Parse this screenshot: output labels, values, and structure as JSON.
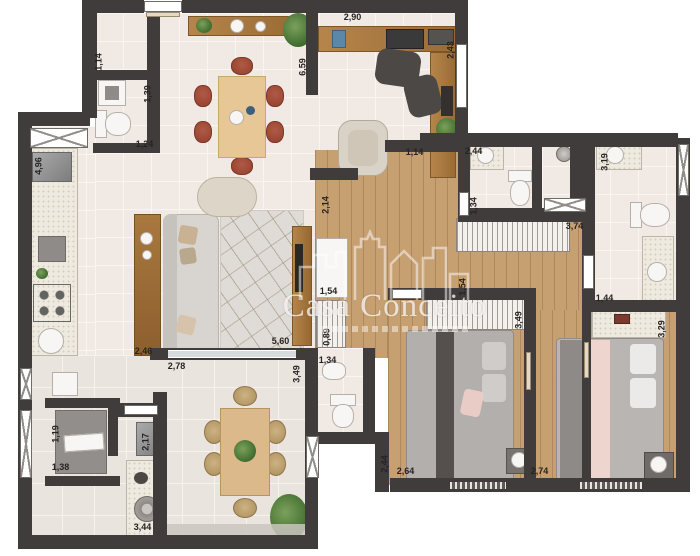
{
  "watermark": {
    "title": "Casa Conceito"
  },
  "dimensions": [
    "1,14",
    "1,39",
    "1,24",
    "4,96",
    "6,59",
    "2,90",
    "2,43",
    "1,14",
    "2,44",
    "3,19",
    "1,34",
    "2,14",
    "3,74",
    "1,54",
    "1,54",
    "1,44",
    "3,29",
    "0,89",
    "5,60",
    "1,34",
    "2,46",
    "2,78",
    "3,49",
    "3,49",
    "1,19",
    "2,17",
    "1,38",
    "3,44",
    "2,44",
    "2,64",
    "2,74"
  ],
  "colors": {
    "wall": "#403c3c",
    "tile": "#f0e9e4",
    "grout": "#faf5f1",
    "balcony_tile": "#eae4de",
    "wood_floor": "#c7a072",
    "wood_furniture": "#a9783f",
    "accent_chair": "#a34b37",
    "sofa": "#d7d3cf",
    "plant": "#4e7a3a",
    "bed_throw": "#e7cbc4",
    "watermark_text": "#fcfaf8"
  }
}
